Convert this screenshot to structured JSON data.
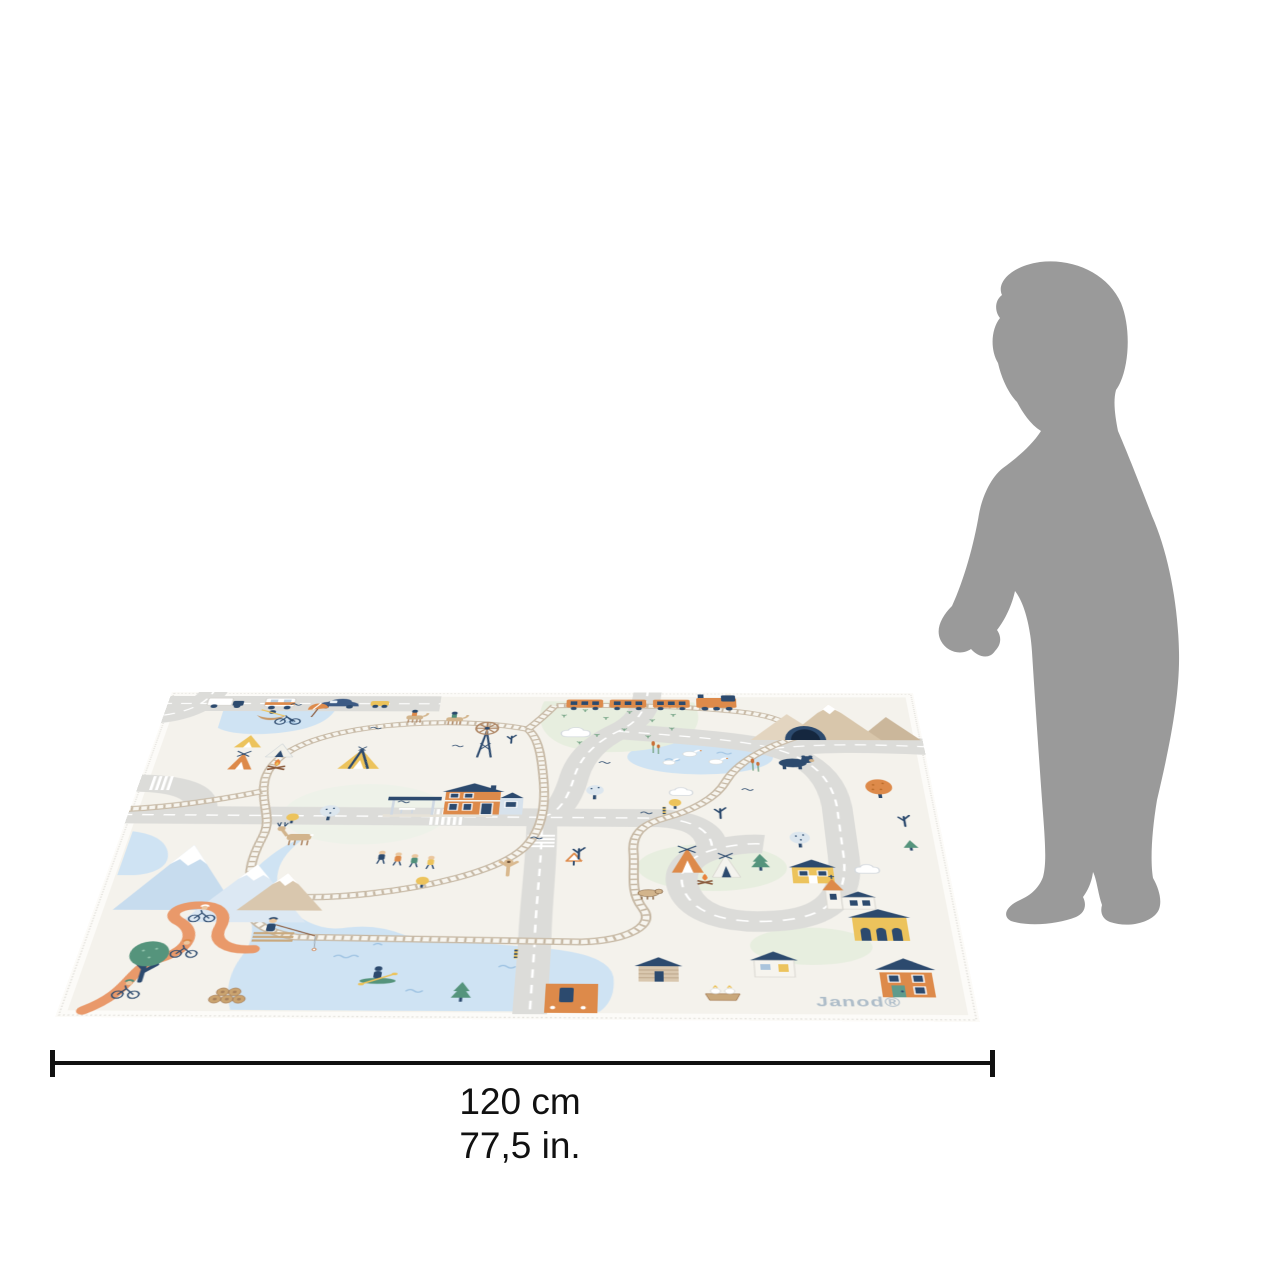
{
  "image_type": "product size reference photo",
  "product": {
    "name": "illustrated children play mat",
    "brand": "Janod®"
  },
  "dimension_label": {
    "cm": "120 cm",
    "inches": "77,5 in."
  },
  "size_reference_figure": "toddler silhouette",
  "colors": {
    "background": "#ffffff",
    "silhouette_gray": "#9a9a9a",
    "dimension_line": "#111111",
    "mat_base": "#f4f2ec",
    "road_gray": "#dcdcd9",
    "water_blue": "#cfe3f3",
    "rail_beige": "#c6b8a4",
    "accent_orange": "#dd8a4a",
    "accent_navy": "#2c4a6e",
    "accent_yellow": "#ecc35c",
    "accent_green": "#55947c",
    "meadow_green": "#e7eedf",
    "mountain_tan": "#d8c6ab",
    "brand_text": "#aebdc9"
  },
  "mat_scene_elements": [
    "lake",
    "rowing-boat",
    "beach-umbrella",
    "bicycle",
    "camping-tents",
    "campfire",
    "railway-loop",
    "train-station",
    "windmill",
    "orange-train",
    "tunnel",
    "snow-mountains",
    "bear",
    "deer",
    "hikers",
    "pony-riders",
    "pond-with-geese",
    "road-network",
    "crosswalks",
    "vehicles",
    "village-houses",
    "church",
    "log-cabin",
    "teepee-camp",
    "cyclists-trail",
    "fisherman-pier",
    "kayaker",
    "log-pile",
    "trees",
    "birds",
    "clouds",
    "level-crossing",
    "harbor-dock"
  ]
}
